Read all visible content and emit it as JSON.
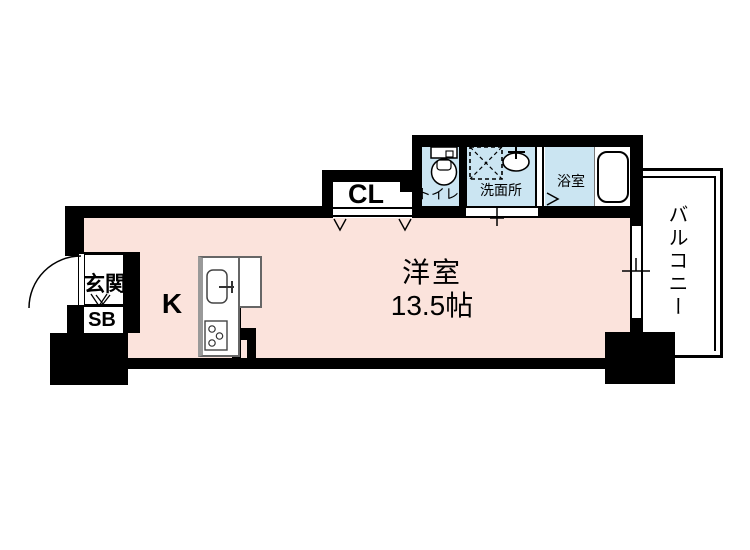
{
  "title": "floor-plan",
  "colors": {
    "room-pink": "#fbe3dc",
    "room-blue": "#cbe5f2",
    "wall": "#000000"
  },
  "rooms": {
    "main": {
      "label": "洋室",
      "size": "13.5帖"
    },
    "kitchen": {
      "label": "K"
    },
    "closet": {
      "label": "CL"
    },
    "entrance": {
      "label": "玄関"
    },
    "shoe_box": {
      "label": "SB"
    },
    "toilet": {
      "label": "トイレ"
    },
    "washroom": {
      "label": "洗面所"
    },
    "bathroom": {
      "label": "浴室"
    },
    "balcony": {
      "label": "バルコニー"
    }
  }
}
